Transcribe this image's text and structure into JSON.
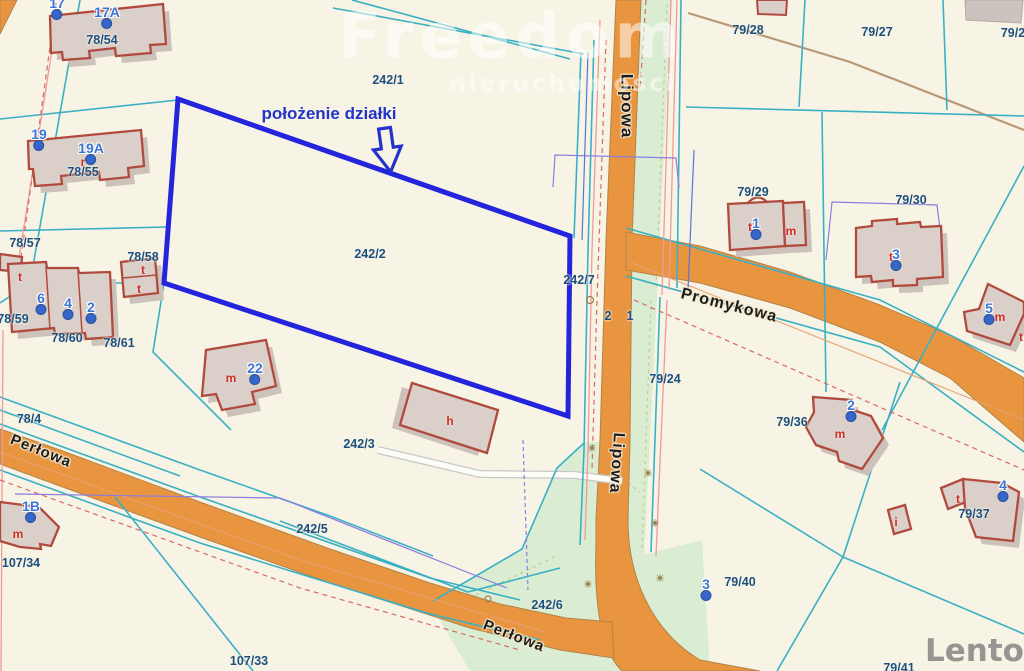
{
  "watermark": {
    "brand": "Freedom",
    "tagline": "nieruchomości"
  },
  "footer_watermark": {
    "brand": "Lento",
    "badge": "pl"
  },
  "annotation": {
    "label": "położenie działki"
  },
  "colors": {
    "highlight_outline": "#2424dd",
    "road_fill": "#e9953f",
    "vegetation_fill": "#daecd2",
    "boundary_cyan": "#3ab0c4",
    "parcel_text": "#1d5080",
    "house_text": "#3c74d4",
    "building_outline": "#b04a3d",
    "building_fill": "#dbcfc9",
    "lento_orange": "#f5821f"
  },
  "street_labels": [
    {
      "text": "Lipowa",
      "x": 627,
      "y": 106,
      "rot": 90,
      "size": 17
    },
    {
      "text": "Lipowa",
      "x": 616,
      "y": 463,
      "rot": 94,
      "size": 16
    },
    {
      "text": "Promykowa",
      "x": 729,
      "y": 306,
      "rot": 14,
      "size": 16
    },
    {
      "text": "Perłowa",
      "x": 41,
      "y": 451,
      "rot": 22,
      "size": 15
    },
    {
      "text": "Perłowa",
      "x": 514,
      "y": 636,
      "rot": 21,
      "size": 15
    }
  ],
  "parcel_labels": [
    {
      "text": "78/54",
      "x": 102,
      "y": 40
    },
    {
      "text": "78/55",
      "x": 83,
      "y": 172
    },
    {
      "text": "78/57",
      "x": 25,
      "y": 243
    },
    {
      "text": "78/58",
      "x": 143,
      "y": 257
    },
    {
      "text": "78/59",
      "x": 13,
      "y": 319
    },
    {
      "text": "78/60",
      "x": 67,
      "y": 338
    },
    {
      "text": "78/61",
      "x": 119,
      "y": 343
    },
    {
      "text": "78/4",
      "x": 29,
      "y": 419
    },
    {
      "text": "107/34",
      "x": 21,
      "y": 563
    },
    {
      "text": "107/33",
      "x": 249,
      "y": 661
    },
    {
      "text": "242/1",
      "x": 388,
      "y": 80
    },
    {
      "text": "242/2",
      "x": 370,
      "y": 254
    },
    {
      "text": "242/3",
      "x": 359,
      "y": 444
    },
    {
      "text": "242/5",
      "x": 312,
      "y": 529
    },
    {
      "text": "242/6",
      "x": 547,
      "y": 605
    },
    {
      "text": "242/7",
      "x": 579,
      "y": 280
    },
    {
      "text": "2",
      "x": 608,
      "y": 316
    },
    {
      "text": "1",
      "x": 630,
      "y": 316
    },
    {
      "text": "79/24",
      "x": 665,
      "y": 379
    },
    {
      "text": "79/28",
      "x": 748,
      "y": 30
    },
    {
      "text": "79/27",
      "x": 877,
      "y": 32
    },
    {
      "text": "79/2",
      "x": 1013,
      "y": 33
    },
    {
      "text": "79/29",
      "x": 753,
      "y": 192
    },
    {
      "text": "79/30",
      "x": 911,
      "y": 200
    },
    {
      "text": "79/36",
      "x": 792,
      "y": 422
    },
    {
      "text": "79/37",
      "x": 974,
      "y": 514
    },
    {
      "text": "79/40",
      "x": 740,
      "y": 582
    },
    {
      "text": "79/41",
      "x": 899,
      "y": 668
    }
  ],
  "house_number_markers": [
    {
      "text": "17",
      "x": 57,
      "y": 8
    },
    {
      "text": "17A",
      "x": 107,
      "y": 17
    },
    {
      "text": "19",
      "x": 39,
      "y": 139
    },
    {
      "text": "19A",
      "x": 91,
      "y": 153
    },
    {
      "text": "6",
      "x": 41,
      "y": 303
    },
    {
      "text": "4",
      "x": 68,
      "y": 308
    },
    {
      "text": "2",
      "x": 91,
      "y": 312
    },
    {
      "text": "22",
      "x": 255,
      "y": 373
    },
    {
      "text": "1B",
      "x": 31,
      "y": 511
    },
    {
      "text": "1",
      "x": 756,
      "y": 228
    },
    {
      "text": "3",
      "x": 896,
      "y": 259
    },
    {
      "text": "5",
      "x": 989,
      "y": 313
    },
    {
      "text": "2",
      "x": 851,
      "y": 410
    },
    {
      "text": "4",
      "x": 1003,
      "y": 490
    },
    {
      "text": "3",
      "x": 706,
      "y": 589
    }
  ],
  "building_letters": [
    {
      "text": "m",
      "x": 231,
      "y": 378
    },
    {
      "text": "h",
      "x": 450,
      "y": 421
    },
    {
      "text": "m",
      "x": 791,
      "y": 231
    },
    {
      "text": "t",
      "x": 750,
      "y": 227
    },
    {
      "text": "t",
      "x": 891,
      "y": 257
    },
    {
      "text": "m",
      "x": 1000,
      "y": 317
    },
    {
      "text": "m",
      "x": 840,
      "y": 434
    },
    {
      "text": "m",
      "x": 18,
      "y": 534
    },
    {
      "text": "i",
      "x": 896,
      "y": 522
    },
    {
      "text": "t",
      "x": 958,
      "y": 499
    },
    {
      "text": "t",
      "x": 143,
      "y": 270
    },
    {
      "text": "t",
      "x": 139,
      "y": 289
    },
    {
      "text": "t",
      "x": 20,
      "y": 277
    },
    {
      "text": "r",
      "x": 83,
      "y": 162
    },
    {
      "text": "t",
      "x": 1021,
      "y": 337
    }
  ]
}
